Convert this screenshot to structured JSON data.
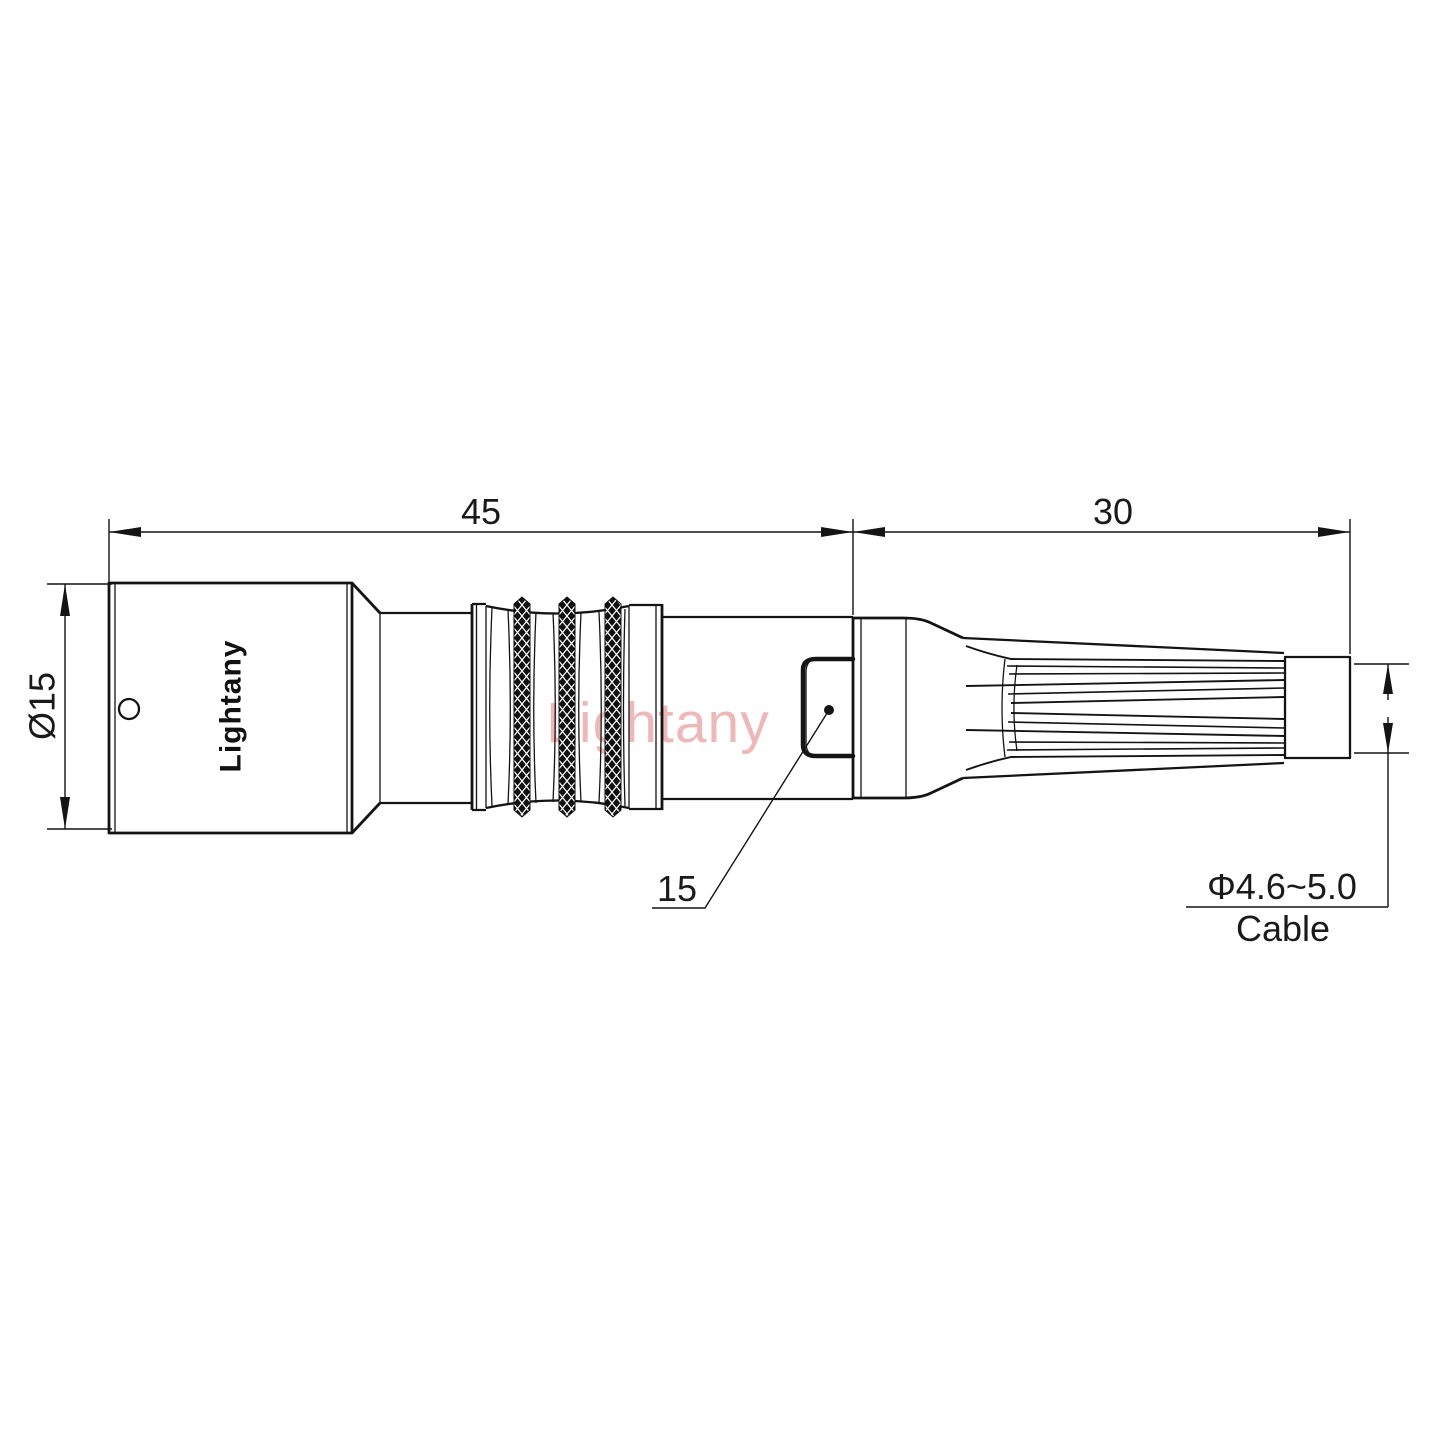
{
  "page": {
    "background": "#ffffff",
    "type": "technical-drawing"
  },
  "colors": {
    "line": "#141414",
    "text": "#1a1a1a",
    "watermark_pink": "#eba7a7",
    "knurl_fill": "#111111"
  },
  "branding": {
    "body_label": "Lightany",
    "watermark_text": "Lightany"
  },
  "dimensions": {
    "overall_length": "45",
    "strain_relief_length": "30",
    "shell_diameter": "Ø15",
    "latch_ref": "15",
    "cable_diameter_range": "Φ4.6~5.0",
    "cable_label": "Cable"
  }
}
